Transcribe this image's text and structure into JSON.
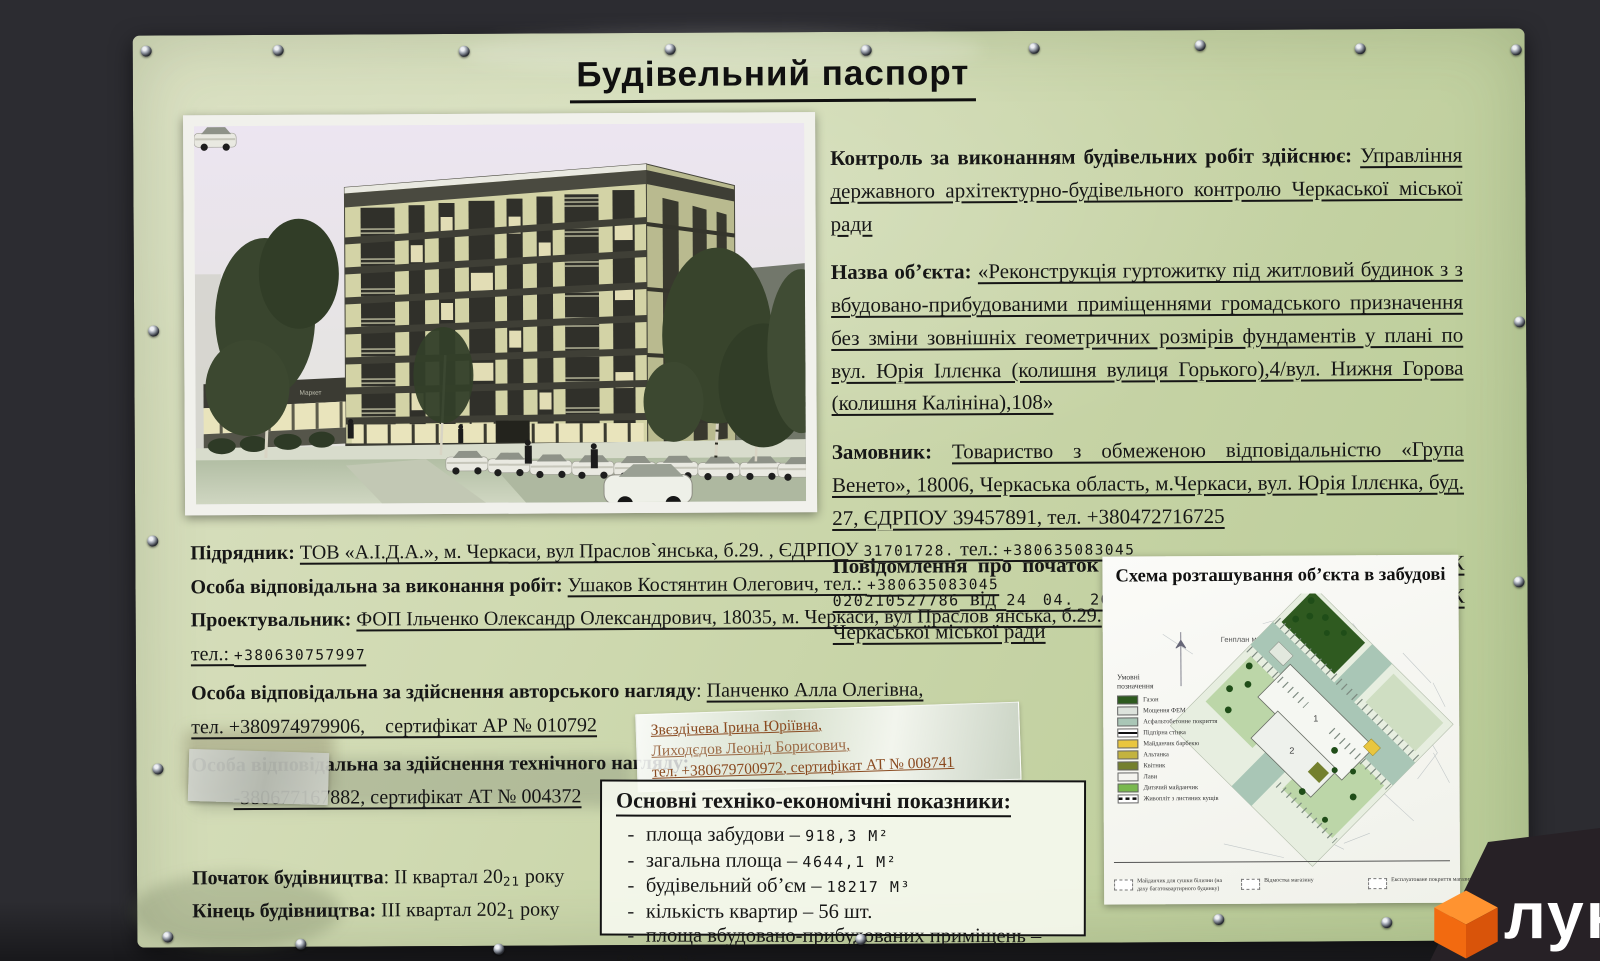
{
  "sign": {
    "title": "Будівельний паспорт",
    "right_paragraphs": [
      {
        "parts": [
          {
            "s": "b",
            "t": "Контроль за виконанням будівельних робіт здійснює: "
          },
          {
            "s": "u",
            "t": "Управління державного архітектурно-будівельного контролю Черкаської міської ради"
          }
        ]
      },
      {
        "parts": [
          {
            "s": "b",
            "t": "Назва об’єкта: "
          },
          {
            "s": "u",
            "t": "«Реконструкція  гуртожитку під житловий будинок з з вбудовано-прибудованими приміщеннями громадського призначення без зміни зовнішніх геометричних розмірів фундаментів у плані по вул. Юрія Іллєнка (колишня вулиця Горького),4/вул. Нижня Горова (колишня Калініна),108»"
          }
        ]
      },
      {
        "parts": [
          {
            "s": "b",
            "t": "Замовник: "
          },
          {
            "s": "u",
            "t": "Товариство з обмеженою відповідальністю «Група Венето», 18006, Черкаська область, м.Черкаси, вул. Юрія Іллєнка, буд. 27, ЄДРПОУ 39457891, тел. +380472716725"
          }
        ]
      },
      {
        "parts": [
          {
            "s": "b",
            "t": "Повідомлення про початок виконання підготовчих робіт: "
          },
          {
            "s": "u",
            "t": "№ЧК "
          },
          {
            "s": "um",
            "t": "020210527786"
          },
          {
            "s": "u",
            "t": " від "
          },
          {
            "s": "um",
            "t": "24  04.  2021"
          },
          {
            "s": "u",
            "t": ", зареєстроване Управлінням ДАБК Черкаської міської ради"
          }
        ]
      }
    ],
    "left_lines": [
      {
        "parts": [
          {
            "s": "b",
            "t": "Підрядник: "
          },
          {
            "s": "u",
            "t": "ТОВ «А.І.Д.А.», м. Черкаси, вул Праслов`янська, б.29. , ЄДРПОУ "
          },
          {
            "s": "um",
            "t": "31701728."
          },
          {
            "s": "u",
            "t": " тел.: "
          },
          {
            "s": "um",
            "t": "+380635083045"
          }
        ]
      },
      {
        "parts": [
          {
            "s": "b",
            "t": "Особа відповідальна за виконання робіт: "
          },
          {
            "s": "u",
            "t": "Ушаков Костянтин Олегович, тел.: "
          },
          {
            "s": "um",
            "t": "+380635083045"
          }
        ]
      },
      {
        "parts": [
          {
            "s": "b",
            "t": "Проектувальник: "
          },
          {
            "s": "u",
            "t": "ФОП Ільченко Олександр Олександрович, 18035, м. Черкаси, вул  Праслов`янська, б.29."
          }
        ]
      },
      {
        "parts": [
          {
            "s": "u",
            "t": "тел.: "
          },
          {
            "s": "um",
            "t": "+380630757997"
          }
        ]
      },
      {
        "mt": 6,
        "parts": [
          {
            "s": "b",
            "t": "Особа відповідальна за здійснення авторського нагляду"
          },
          {
            "s": "r",
            "t": ": "
          },
          {
            "s": "u",
            "t": "Панченко Алла Олегівна,"
          }
        ]
      },
      {
        "parts": [
          {
            "s": "u",
            "t": " тел. +380974979906,    сертифікат АР № 010792 "
          }
        ]
      },
      {
        "mt": 4,
        "parts": [
          {
            "s": "b",
            "t": "Особа відповідальна за здійснення технічного нагляду: "
          }
        ]
      },
      {
        "indent": 42,
        "parts": [
          {
            "s": "u",
            "t": "-380677167882, сертифікат АТ № 004372"
          }
        ]
      },
      {
        "mt": 46,
        "parts": [
          {
            "s": "b",
            "t": "Початок будівництва"
          },
          {
            "s": "r",
            "t": ": ІІ квартал 20"
          },
          {
            "s": "sm",
            "t": "21"
          },
          {
            "s": "r",
            "t": " року"
          }
        ]
      },
      {
        "parts": [
          {
            "s": "b",
            "t": "Кінець будівництва: "
          },
          {
            "s": "r",
            "t": "ІІІ квартал 202"
          },
          {
            "s": "sm",
            "t": "1"
          },
          {
            "s": "r",
            "t": " року"
          }
        ]
      }
    ],
    "tape_lines": [
      "Звєздічева Ірина Юріївна,",
      "Лиходєдов Леонід Борисович,",
      "тел. +380679700972, сертифікат АТ № 008741"
    ],
    "indicators": {
      "title": "Основні техніко-економічні показники:",
      "items": [
        {
          "name": "площа забудови",
          "value": "918,3",
          "unit": "М²",
          "mono": true
        },
        {
          "name": "загальна площа",
          "value": "4644,1",
          "unit": "М²",
          "mono": true
        },
        {
          "name": "будівельний об’єм",
          "value": "18217",
          "unit": "М³",
          "mono": true
        },
        {
          "name": "кількість квартир",
          "value": "56",
          "unit": "шт.",
          "mono": false
        },
        {
          "name": "площа вбудовано-прибудованих приміщень",
          "value": "582,1",
          "unit": "М²",
          "mono": true
        }
      ]
    },
    "rendering": {
      "market_label": "Маркет"
    },
    "siteplan": {
      "title": "Схема розташування об’єкта в забудові",
      "plan_label": "Генплан м1:500",
      "legend_title": "Умовні позначення",
      "legend": [
        {
          "label": "Газон",
          "color": "#2d5a1e",
          "type": "fill"
        },
        {
          "label": "Мощення ФЕМ",
          "color": "#dde3dc",
          "type": "fill"
        },
        {
          "label": "Асфальтобетонне покриття",
          "color": "#a9c6b6",
          "type": "fill"
        },
        {
          "label": "Підпірна стінка",
          "color": "#111111",
          "type": "line"
        },
        {
          "label": "Майданчик барбекю",
          "color": "#e9c63e",
          "type": "fill"
        },
        {
          "label": "Альтанка",
          "color": "#c3b33f",
          "type": "fill"
        },
        {
          "label": "Квітник",
          "color": "#74802e",
          "type": "fill"
        },
        {
          "label": "Лави",
          "color": "#f4f4ef",
          "type": "fill"
        },
        {
          "label": "Дитячий майданчик",
          "color": "#79b84e",
          "type": "fill"
        },
        {
          "label": "Живопліт з листяних кущів",
          "color": "#111111",
          "type": "dashline"
        }
      ],
      "legend_bottom": [
        {
          "label": "Майданчик для сушки білизни (на даху багатоквартирного будинку)"
        },
        {
          "label": "Відмостка магазину"
        },
        {
          "label": "Експлуатоване покриття магазину"
        }
      ],
      "building_numbers": {
        "b1": "1",
        "b2": "2"
      }
    }
  },
  "logo": {
    "text": "лун"
  },
  "colors": {
    "sign_green": "#cbd6a9",
    "wall_dark": "#2c2c31",
    "logo_orange": "#f4690f",
    "map_asphalt": "#a9c6b6",
    "map_lawn": "#2f5a20"
  }
}
